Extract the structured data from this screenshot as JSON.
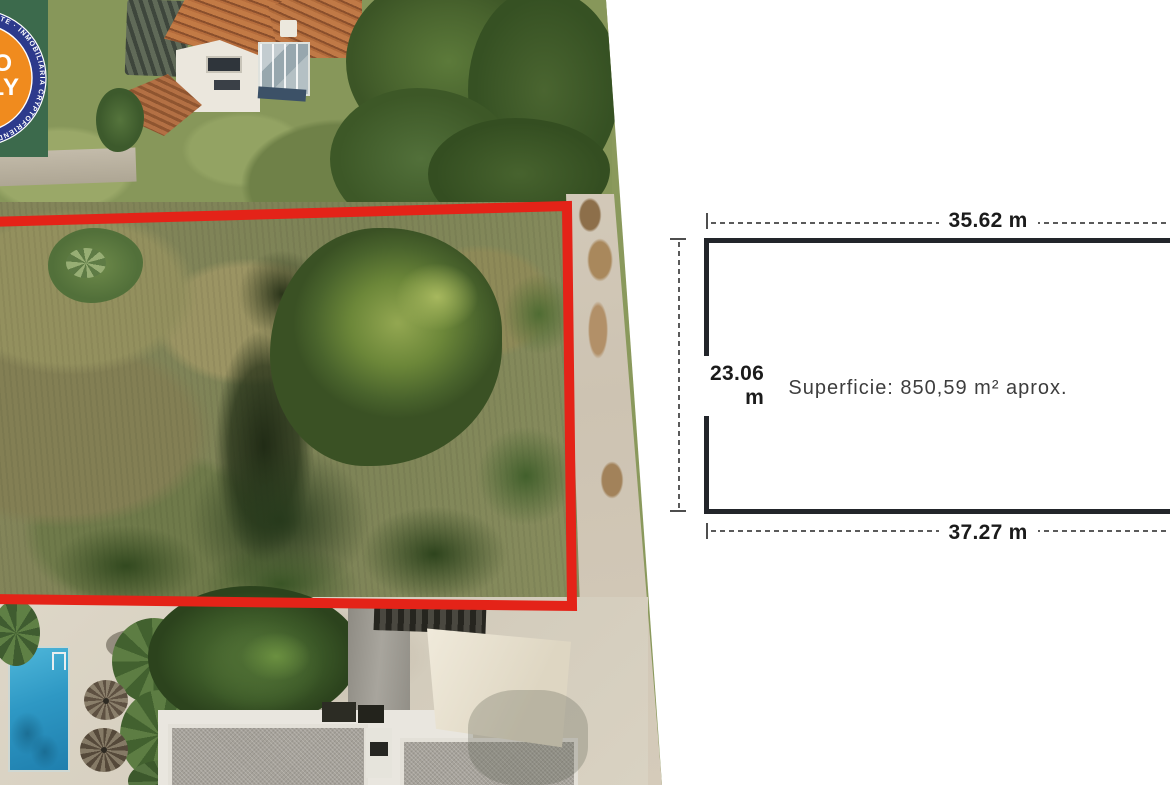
{
  "watermark": {
    "ring_text": "ESTATE · INMOBILIARIA CRYPTOFRIENDLY REAL ESTATE · INMOBILIARIA CRYPTOFRIENDLY REAL ESTATE ·",
    "center_top": "O",
    "center_bottom": "LY",
    "colors": {
      "ring": "#2c3a8c",
      "center": "#f08b1e",
      "panel": "#3c6a4c"
    }
  },
  "plot": {
    "outline_color": "#e42318"
  },
  "diagram": {
    "top_width": "35.62 m",
    "left_height": "23.06 m",
    "bottom_width": "37.27 m",
    "area_label": "Superficie: 850,59 m² aprox.",
    "outline_color": "#22252a"
  }
}
